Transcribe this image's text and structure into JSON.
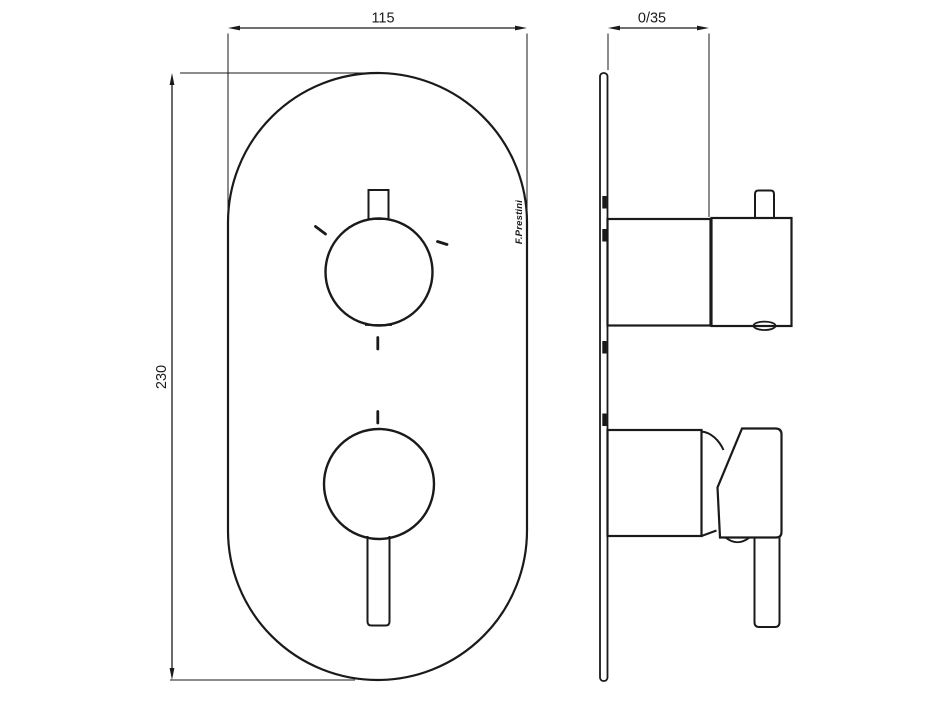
{
  "drawing": {
    "brand": "F.Prestini",
    "dimensions": {
      "width": "115",
      "height": "230",
      "depth": "0/35"
    },
    "colors": {
      "line": "#1a1a1a",
      "background": "#ffffff"
    }
  }
}
